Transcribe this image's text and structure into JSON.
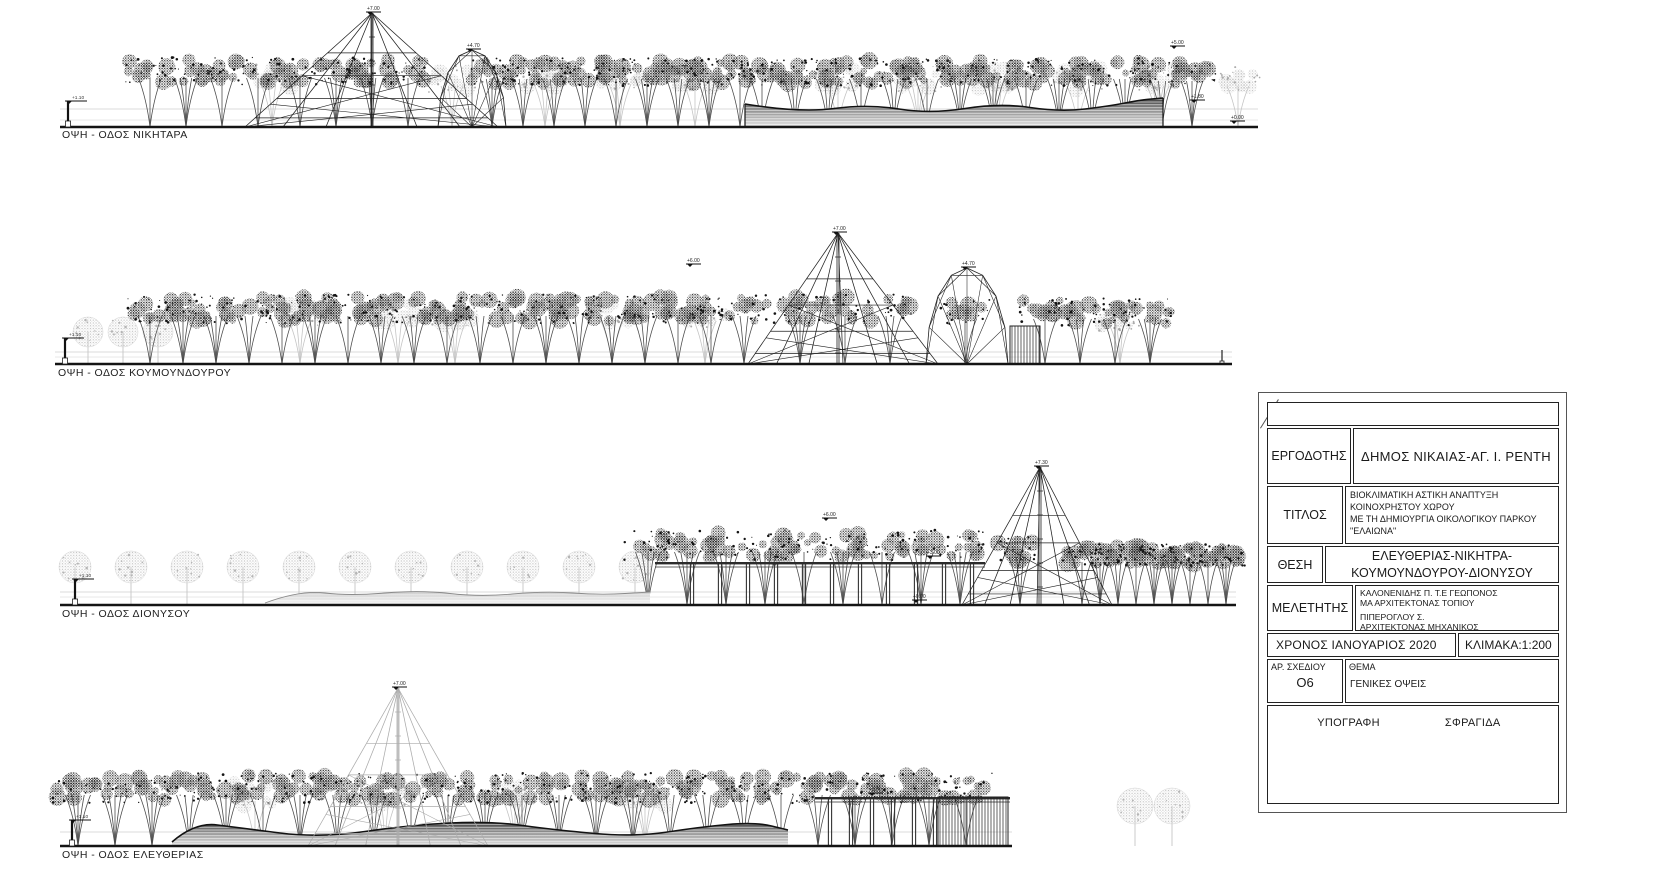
{
  "sheet": {
    "background": "#ffffff",
    "line_color": "#1a1a1a"
  },
  "title_block": {
    "client_label": "ΕΡΓΟΔΟΤΗΣ",
    "client": "ΔΗΜΟΣ ΝΙΚΑΙΑΣ-ΑΓ. Ι. ΡΕΝΤΗ",
    "title_label": "ΤΙΤΛΟΣ",
    "title_lines": [
      "ΒΙΟΚΛΙΜΑΤΙΚΗ ΑΣΤΙΚΗ ΑΝΑΠΤΥΞΗ",
      "ΚΟΙΝΟΧΡΗΣΤΟΥ ΧΩΡΟΥ",
      "ΜΕ ΤΗ ΔΗΜΙΟΥΡΓΙΑ ΟΙΚΟΛΟΓΙΚΟΥ ΠΑΡΚΟΥ",
      "\"ΕΛΑΙΩΝΑ\""
    ],
    "location_label": "ΘΕΣΗ",
    "location_lines": [
      "ΕΛΕΥΘΕΡΙΑΣ-ΝΙΚΗΤΡΑ-",
      "ΚΟΥΜΟΥΝΔΟΥΡΟΥ-ΔΙΟΝΥΣΟΥ"
    ],
    "designer_label": "ΜΕΛΕΤΗΤΗΣ",
    "designer_lines": [
      "ΚΑΛΟΝΕΝΙΔΗΣ Π. Τ.Ε ΓΕΩΠΟΝΟΣ",
      "ΜΑ ΑΡΧΙΤΕΚΤΟΝΑΣ ΤΟΠΙΟΥ",
      "ΠΙΠΕΡΟΓΛΟΥ Σ.",
      "ΑΡΧΙΤΕΚΤΟΝΑΣ ΜΗΧΑΝΙΚΟΣ"
    ],
    "date": "ΧΡΟΝΟΣ  ΙΑΝΟΥΑΡΙΟΣ 2020",
    "scale": "ΚΛΙΜΑΚΑ:1:200",
    "drawing_no_label": "ΑΡ. ΣΧΕΔΙΟΥ",
    "drawing_no": "Ο6",
    "subject_label": "ΘΕΜΑ",
    "subject": "ΓΕΝΙΚΕΣ ΟΨΕΙΣ",
    "signature_label": "ΥΠΟΓΡΑΦΗ",
    "stamp_label": "ΣΦΡΑΓΙΔΑ"
  },
  "elevations": [
    {
      "id": "nikitara",
      "label": "ΟΨΗ - ΟΔΟΣ ΝΙΚΗΤΑΡΑ",
      "baseline": 127,
      "guide": 109,
      "guide2": 120,
      "x0": 60,
      "x1": 1258,
      "marker": {
        "x": 68,
        "level": "+1.10"
      },
      "tree_rows": [
        {
          "from": 272,
          "to": 272,
          "step": 40,
          "type": "light",
          "rise": 50,
          "w": 44
        },
        {
          "from": 452,
          "to": 452,
          "step": 40,
          "type": "light",
          "rise": 48,
          "w": 44
        },
        {
          "from": 545,
          "to": 695,
          "step": 75,
          "type": "light",
          "rise": 50,
          "w": 44
        },
        {
          "from": 838,
          "to": 1238,
          "step": 80,
          "type": "light",
          "rise": 48,
          "w": 44
        },
        {
          "from": 150,
          "to": 258,
          "step": 36,
          "type": "dark",
          "rise": 56,
          "w": 46
        },
        {
          "from": 300,
          "to": 408,
          "step": 36,
          "type": "dark",
          "rise": 56,
          "w": 46
        },
        {
          "from": 492,
          "to": 740,
          "step": 31,
          "type": "dark",
          "rise": 55,
          "w": 46
        },
        {
          "from": 762,
          "to": 1128,
          "step": 33,
          "type": "dark",
          "rise": 55,
          "w": 46
        },
        {
          "from": 1162,
          "to": 1192,
          "step": 30,
          "type": "dark",
          "rise": 53,
          "w": 44
        }
      ],
      "structures": [
        {
          "type": "mound",
          "tone": "dark",
          "x0": 745,
          "x1": 1163,
          "edges": true,
          "top": [
            [
              745,
              104
            ],
            [
              800,
              113
            ],
            [
              868,
              104
            ],
            [
              930,
              114
            ],
            [
              1000,
              103
            ],
            [
              1060,
              112
            ],
            [
              1110,
              106
            ],
            [
              1140,
              100
            ],
            [
              1163,
              98
            ]
          ]
        },
        {
          "type": "pyramid",
          "tone": "dark",
          "apex": [
            372,
            13
          ],
          "x0": 245,
          "x1": 498,
          "level": "+7.00"
        },
        {
          "type": "dome",
          "tone": "dark",
          "x0": 438,
          "x1": 506,
          "top": 50,
          "level": "+4.70"
        }
      ],
      "annotations": [
        {
          "x": 1176,
          "y": 46,
          "level": "+5.00"
        },
        {
          "x": 1196,
          "y": 100,
          "level": "+1.80"
        },
        {
          "x": 1236,
          "y": 121,
          "level": "+0.00"
        }
      ]
    },
    {
      "id": "koumoundourou",
      "label": "ΟΨΗ - ΟΔΟΣ ΚΟΥΜΟΥΝΔΟΥΡΟΥ",
      "baseline": 364,
      "guide": 352,
      "guide2": 357,
      "x0": 55,
      "x1": 1232,
      "marker": {
        "x": 65,
        "level": "+1.10"
      },
      "tree_rows": [
        {
          "from": 88,
          "to": 158,
          "step": 35,
          "type": "ball",
          "rise": 32,
          "r": 15
        },
        {
          "from": 300,
          "to": 300,
          "step": 40,
          "type": "light",
          "rise": 50,
          "w": 44
        },
        {
          "from": 398,
          "to": 455,
          "step": 57,
          "type": "light",
          "rise": 50,
          "w": 44
        },
        {
          "from": 612,
          "to": 705,
          "step": 93,
          "type": "light",
          "rise": 50,
          "w": 44
        },
        {
          "from": 150,
          "to": 775,
          "step": 33,
          "type": "dark",
          "rise": 55,
          "w": 48
        },
        {
          "from": 800,
          "to": 890,
          "step": 45,
          "type": "dark",
          "rise": 55,
          "w": 48
        },
        {
          "from": 965,
          "to": 965,
          "step": 40,
          "type": "dark",
          "rise": 52,
          "w": 46
        },
        {
          "from": 1120,
          "to": 1120,
          "step": 40,
          "type": "light",
          "rise": 46,
          "w": 42
        },
        {
          "from": 1045,
          "to": 1150,
          "step": 35,
          "type": "dark",
          "rise": 52,
          "w": 46
        }
      ],
      "structures": [
        {
          "type": "pyramid",
          "tone": "dark",
          "apex": [
            838,
            233
          ],
          "x0": 748,
          "x1": 938,
          "level": "+7.00"
        },
        {
          "type": "dome",
          "tone": "dark",
          "x0": 926,
          "x1": 1008,
          "top": 268,
          "level": "+4.70"
        },
        {
          "type": "slats",
          "x0": 1010,
          "x1": 1040,
          "y0": 326
        },
        {
          "type": "pole",
          "x": 1222,
          "y0": 350
        }
      ],
      "annotations": [
        {
          "x": 692,
          "y": 264,
          "level": "+6.00"
        }
      ]
    },
    {
      "id": "dionysou",
      "label": "ΟΨΗ - ΟΔΟΣ ΔΙΟΝΥΣΟΥ",
      "baseline": 605,
      "guide": 592,
      "guide2": 597,
      "x0": 60,
      "x1": 1236,
      "marker": {
        "x": 75,
        "level": "+1.10"
      },
      "tree_rows": [
        {
          "from": 75,
          "to": 635,
          "step": 56,
          "type": "ball",
          "rise": 38,
          "r": 16
        },
        {
          "from": 648,
          "to": 960,
          "step": 39,
          "type": "dark",
          "rise": 60,
          "w": 50
        },
        {
          "from": 1020,
          "to": 1020,
          "step": 40,
          "type": "dark",
          "rise": 55,
          "w": 44
        },
        {
          "from": 1082,
          "to": 1230,
          "step": 18,
          "type": "dark",
          "rise": 50,
          "w": 36
        }
      ],
      "structures": [
        {
          "type": "mound",
          "tone": "light",
          "x0": 265,
          "x1": 650,
          "top": [
            [
              265,
              603
            ],
            [
              300,
              590
            ],
            [
              350,
              596
            ],
            [
              420,
              590
            ],
            [
              480,
              597
            ],
            [
              545,
              591
            ],
            [
              600,
              595
            ],
            [
              650,
              592
            ]
          ]
        },
        {
          "type": "pergola",
          "x0": 655,
          "x1": 985,
          "beam": 562,
          "post_from": 692,
          "post_to": 978,
          "post_step": 28
        },
        {
          "type": "pyramid",
          "tone": "dark",
          "apex": [
            1040,
            467
          ],
          "x0": 962,
          "x1": 1112,
          "level": "+7.30"
        }
      ],
      "annotations": [
        {
          "x": 828,
          "y": 518,
          "level": "+6.00"
        },
        {
          "x": 932,
          "y": 556,
          "level": "+3.00"
        },
        {
          "x": 918,
          "y": 600,
          "level": "+0.00"
        }
      ]
    },
    {
      "id": "eleftherias",
      "label": "ΟΨΗ - ΟΔΟΣ ΕΛΕΥΘΕΡΙΑΣ",
      "baseline": 846,
      "guide": 832,
      "x0": 60,
      "x1": 1012,
      "marker": {
        "x": 72,
        "level": "+1.10"
      },
      "tree_rows": [
        {
          "from": 255,
          "to": 645,
          "step": 130,
          "type": "light",
          "rise": 52,
          "w": 46
        },
        {
          "from": 78,
          "to": 1000,
          "step": 37,
          "type": "dark",
          "rise": 58,
          "w": 50
        },
        {
          "from": 1135,
          "to": 1172,
          "step": 37,
          "type": "ball",
          "rise": 40,
          "r": 18
        }
      ],
      "structures": [
        {
          "type": "mound",
          "tone": "dark",
          "x0": 172,
          "x1": 788,
          "top": [
            [
              172,
              842
            ],
            [
              195,
              822
            ],
            [
              240,
              828
            ],
            [
              320,
              838
            ],
            [
              410,
              825
            ],
            [
              490,
              821
            ],
            [
              555,
              830
            ],
            [
              635,
              837
            ],
            [
              700,
              827
            ],
            [
              755,
              822
            ],
            [
              788,
              830
            ]
          ]
        },
        {
          "type": "pyramid",
          "tone": "light",
          "apex": [
            398,
            688
          ],
          "x0": 308,
          "x1": 488,
          "level": "+7.00"
        },
        {
          "type": "pergola",
          "x0": 815,
          "x1": 1010,
          "beam": 797,
          "post_from": 830,
          "post_to": 936,
          "post_step": 21
        },
        {
          "type": "slats",
          "x0": 938,
          "x1": 1008,
          "y0": 797
        }
      ],
      "annotations": [
        {
          "x": 874,
          "y": 793,
          "level": "+3.00"
        }
      ]
    }
  ]
}
